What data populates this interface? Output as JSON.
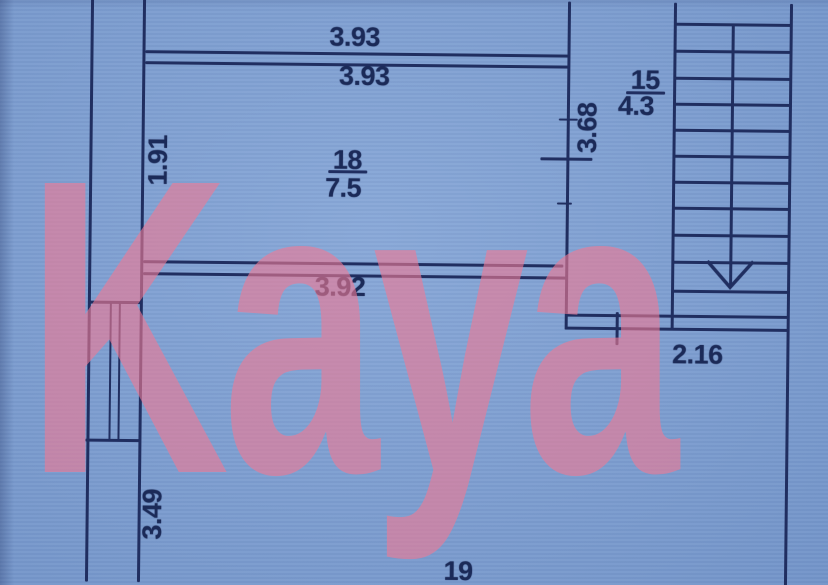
{
  "palette": {
    "background": "#7c9fd4",
    "line": "#202e60",
    "text": "#1b2a58",
    "watermark": "#ee7a95"
  },
  "watermark": {
    "text": "Kaya"
  },
  "rooms": {
    "room18": {
      "number": "18",
      "area": "7.5"
    },
    "room15": {
      "number": "15",
      "area": "4.3"
    },
    "room19": {
      "number": "19"
    }
  },
  "dimensions": {
    "upper_width": "3.93",
    "room18_width": "3.93",
    "room18_depth": "1.91",
    "room18_lower_width": "3.92",
    "stair_hall_depth": "3.68",
    "stair_hall_width": "2.16",
    "left_wall_segment": "3.49"
  }
}
